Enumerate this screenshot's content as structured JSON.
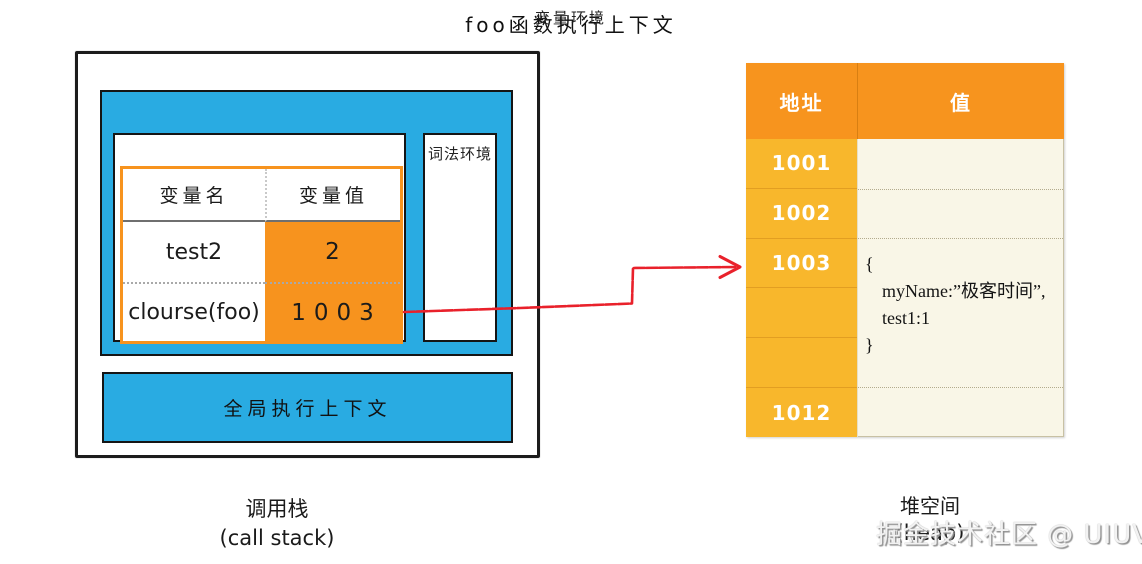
{
  "colors": {
    "context_blue": "#29ABE2",
    "table_orange": "#F7931E",
    "heap_header_orange": "#F7941E",
    "heap_address_amber": "#F8B72C",
    "heap_value_cream": "#F9F6E7",
    "arrow_red": "#E9212B",
    "watermark_gray": "#BFBFBF"
  },
  "call_stack": {
    "foo_context": {
      "title": "foo函数执行上下文",
      "variable_env": {
        "title": "变量环境",
        "table": {
          "headers": [
            "变量名",
            "变量值"
          ],
          "rows": [
            {
              "name": "test2",
              "value": "2"
            },
            {
              "name": "clourse(foo)",
              "value": "1003"
            }
          ]
        }
      },
      "lexical_env": {
        "title": "词法环境"
      }
    },
    "global_context": {
      "title": "全局执行上下文"
    },
    "caption": "调用栈",
    "caption_sub": "(call stack)"
  },
  "heap": {
    "headers": [
      "地址",
      "值"
    ],
    "address_cells": [
      "1001",
      "1002",
      "1003",
      "",
      "",
      "1012"
    ],
    "object": {
      "at_address": "1003",
      "lines": [
        "{",
        "myName:”极客时间”,",
        "test1:1",
        "}"
      ]
    },
    "caption": "堆空间",
    "caption_sub": "(heap)"
  },
  "pointer_arrow": {
    "from_value": "1003",
    "to_address": "1003"
  },
  "watermark": "掘金技术社区 @ UIUV"
}
